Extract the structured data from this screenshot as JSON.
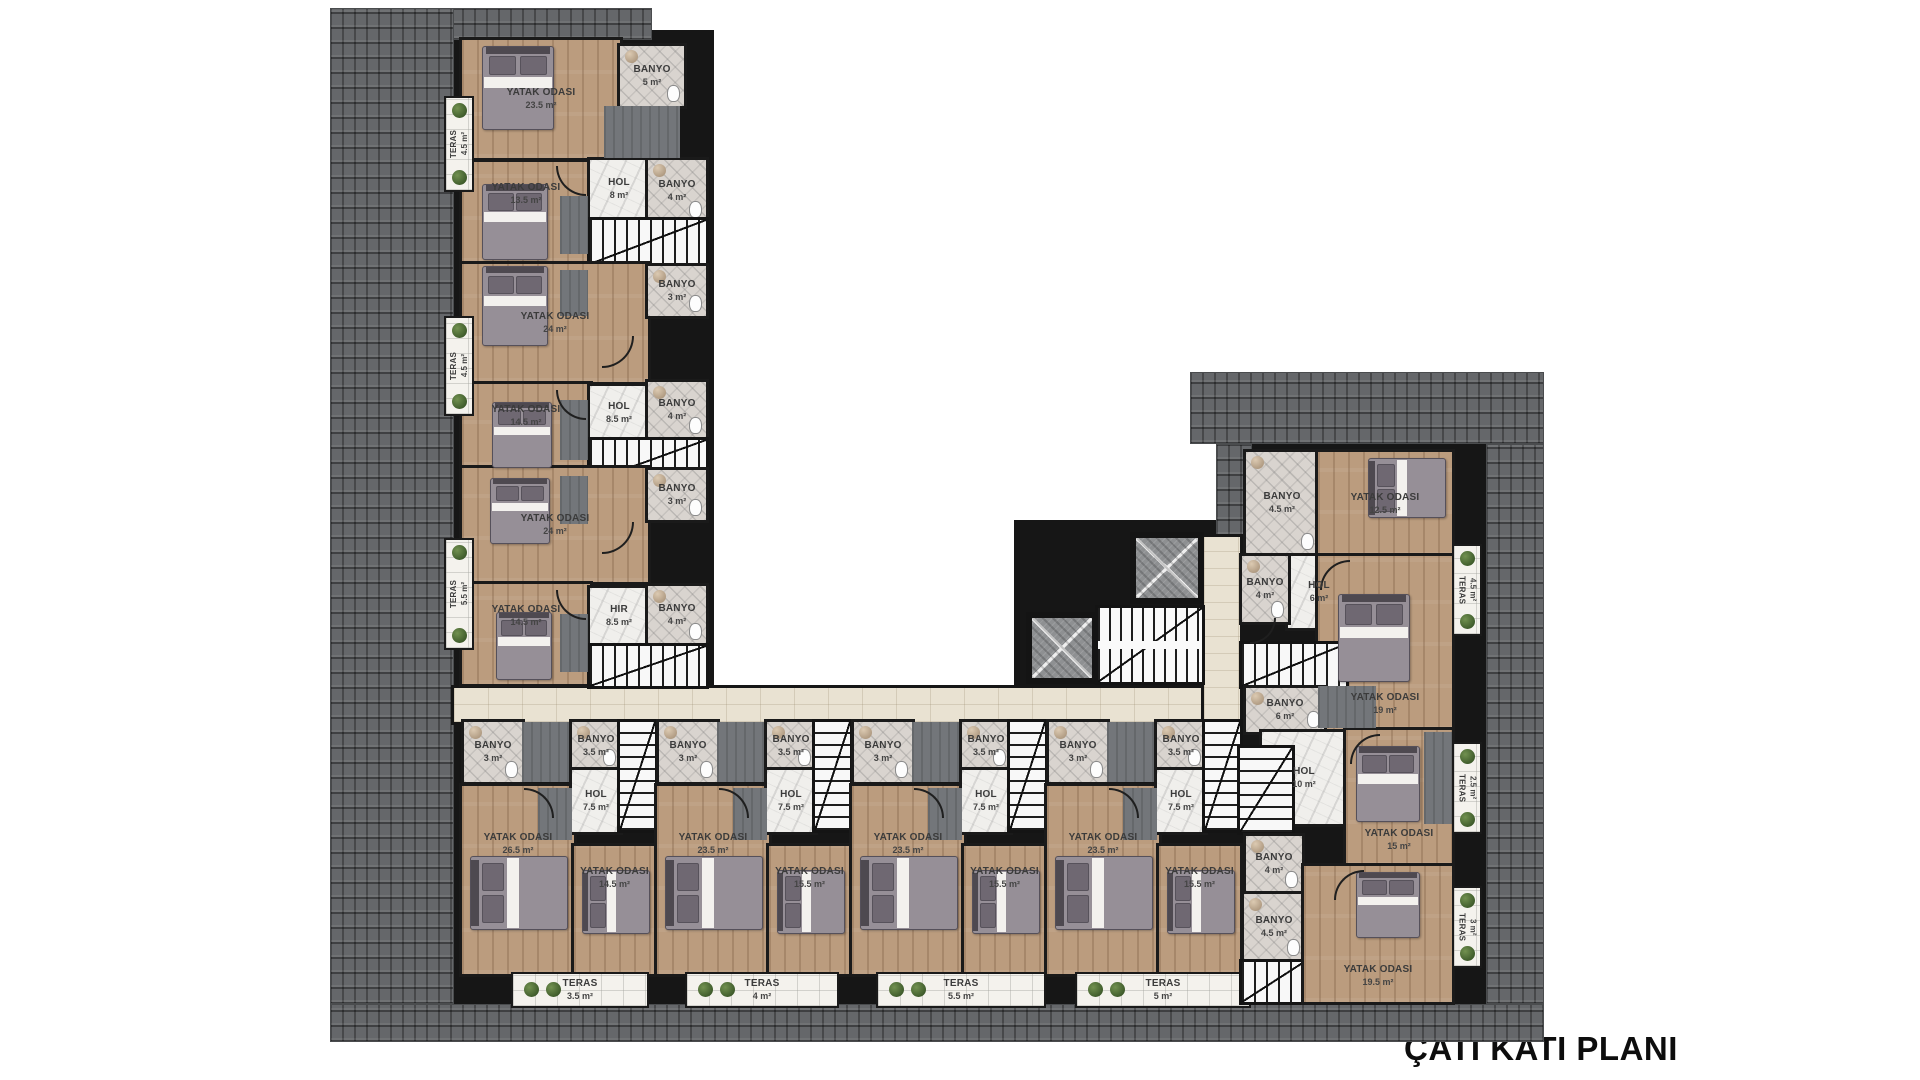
{
  "title": "ÇATI KATI PLANI",
  "title_pos": {
    "x": 1404,
    "y": 1030
  },
  "palette": {
    "roof": "#65676a",
    "wall": "#161616",
    "wood": "#bb9c7e",
    "marble": "#f0efec",
    "bath": "#d9d4cf",
    "travertine": "#e9e2d2",
    "terrace": "#f4f2ed",
    "plant": "#44612f"
  },
  "elements": [
    {
      "t": "wallbg",
      "x": 452,
      "y": 30,
      "w": 262,
      "h": 660
    },
    {
      "t": "wallbg",
      "x": 452,
      "y": 712,
      "w": 802,
      "h": 296
    },
    {
      "t": "wallbg",
      "x": 1236,
      "y": 444,
      "w": 250,
      "h": 562
    },
    {
      "t": "wallbg",
      "x": 1014,
      "y": 520,
      "w": 204,
      "h": 172
    },
    {
      "t": "roof",
      "x": 330,
      "y": 8,
      "w": 322,
      "h": 32
    },
    {
      "t": "roof",
      "x": 330,
      "y": 8,
      "w": 124,
      "h": 996
    },
    {
      "t": "roof",
      "x": 330,
      "y": 1004,
      "w": 1214,
      "h": 38
    },
    {
      "t": "roof",
      "x": 553,
      "y": 40,
      "w": 62,
      "h": 46
    },
    {
      "t": "roof",
      "x": 1190,
      "y": 372,
      "w": 354,
      "h": 72
    },
    {
      "t": "roof",
      "x": 1216,
      "y": 444,
      "w": 36,
      "h": 92
    },
    {
      "t": "roof",
      "x": 1486,
      "y": 444,
      "w": 58,
      "h": 560
    },
    {
      "t": "corridor",
      "x": 454,
      "y": 688,
      "w": 758,
      "h": 34
    },
    {
      "t": "corridor",
      "x": 1204,
      "y": 537,
      "w": 36,
      "h": 185
    },
    {
      "t": "wood",
      "x": 462,
      "y": 40,
      "w": 158,
      "h": 118,
      "l": "YATAK ODASI",
      "a": "23.5 m²"
    },
    {
      "t": "bath",
      "x": 620,
      "y": 46,
      "w": 64,
      "h": 60,
      "l": "BANYO",
      "a": "5 m²"
    },
    {
      "t": "wood",
      "x": 462,
      "y": 162,
      "w": 128,
      "h": 100,
      "l": "YATAK ODASI",
      "a": "13.5 m²",
      "lp": "t"
    },
    {
      "t": "marble",
      "x": 590,
      "y": 160,
      "w": 58,
      "h": 58,
      "l": "HOL",
      "a": "8 m²"
    },
    {
      "t": "bath",
      "x": 648,
      "y": 160,
      "w": 58,
      "h": 62,
      "l": "BANYO",
      "a": "4 m²"
    },
    {
      "t": "stairsv",
      "x": 590,
      "y": 220,
      "w": 116,
      "h": 44
    },
    {
      "t": "wood",
      "x": 462,
      "y": 264,
      "w": 186,
      "h": 118,
      "l": "YATAK ODASI",
      "a": "24 m²"
    },
    {
      "t": "bath",
      "x": 648,
      "y": 266,
      "w": 58,
      "h": 50,
      "l": "BANYO",
      "a": "3 m²"
    },
    {
      "t": "wood",
      "x": 462,
      "y": 384,
      "w": 128,
      "h": 82,
      "l": "YATAK ODASI",
      "a": "14.5 m²",
      "lp": "t"
    },
    {
      "t": "marble",
      "x": 590,
      "y": 386,
      "w": 58,
      "h": 54,
      "l": "HOL",
      "a": "8.5 m²"
    },
    {
      "t": "bath",
      "x": 648,
      "y": 382,
      "w": 58,
      "h": 56,
      "l": "BANYO",
      "a": "4 m²"
    },
    {
      "t": "stairsv",
      "x": 590,
      "y": 440,
      "w": 116,
      "h": 42
    },
    {
      "t": "wood",
      "x": 462,
      "y": 468,
      "w": 186,
      "h": 114,
      "l": "YATAK ODASI",
      "a": "24 m²"
    },
    {
      "t": "bath",
      "x": 648,
      "y": 470,
      "w": 58,
      "h": 50,
      "l": "BANYO",
      "a": "3 m²"
    },
    {
      "t": "wood",
      "x": 462,
      "y": 584,
      "w": 128,
      "h": 100,
      "l": "YATAK ODASI",
      "a": "14.5 m²",
      "lp": "t"
    },
    {
      "t": "marble",
      "x": 590,
      "y": 588,
      "w": 58,
      "h": 56,
      "l": "HIR",
      "a": "8.5 m²"
    },
    {
      "t": "bath",
      "x": 648,
      "y": 586,
      "w": 58,
      "h": 58,
      "l": "BANYO",
      "a": "4 m²"
    },
    {
      "t": "stairsv",
      "x": 590,
      "y": 646,
      "w": 116,
      "h": 40
    },
    {
      "t": "patch",
      "x": 604,
      "y": 106,
      "w": 76,
      "h": 52
    },
    {
      "t": "patch",
      "x": 560,
      "y": 196,
      "w": 28,
      "h": 58
    },
    {
      "t": "patch",
      "x": 560,
      "y": 270,
      "w": 28,
      "h": 46
    },
    {
      "t": "patch",
      "x": 560,
      "y": 400,
      "w": 28,
      "h": 60
    },
    {
      "t": "patch",
      "x": 560,
      "y": 476,
      "w": 28,
      "h": 48
    },
    {
      "t": "patch",
      "x": 560,
      "y": 614,
      "w": 28,
      "h": 58
    },
    {
      "t": "terasvl",
      "x": 446,
      "y": 98,
      "w": 26,
      "h": 92,
      "l": "TERAS",
      "a": "4.5 m²"
    },
    {
      "t": "terasvl",
      "x": 446,
      "y": 318,
      "w": 26,
      "h": 96,
      "l": "TERAS",
      "a": "4.5 m²"
    },
    {
      "t": "terasvl",
      "x": 446,
      "y": 540,
      "w": 26,
      "h": 108,
      "l": "TERAS",
      "a": "5.5 m²"
    },
    {
      "t": "wood",
      "x": 462,
      "y": 786,
      "w": 112,
      "h": 188,
      "l": "YATAK ODASI",
      "a": "26.5 m²",
      "lp": "t2"
    },
    {
      "t": "wood",
      "x": 574,
      "y": 846,
      "w": 81,
      "h": 128,
      "l": "YATAK ODASI",
      "a": "14.5 m²",
      "lp": "t"
    },
    {
      "t": "bath",
      "x": 464,
      "y": 722,
      "w": 58,
      "h": 60,
      "l": "BANYO",
      "a": "3 m²"
    },
    {
      "t": "patch",
      "x": 522,
      "y": 722,
      "w": 50,
      "h": 60
    },
    {
      "t": "bath",
      "x": 572,
      "y": 722,
      "w": 48,
      "h": 48,
      "l": "BANYO",
      "a": "3.5 m²"
    },
    {
      "t": "marble",
      "x": 572,
      "y": 770,
      "w": 48,
      "h": 62,
      "l": "HOL",
      "a": "7.5 m²"
    },
    {
      "t": "stairsh",
      "x": 620,
      "y": 722,
      "w": 35,
      "h": 108
    },
    {
      "t": "patch",
      "x": 538,
      "y": 788,
      "w": 34,
      "h": 52
    },
    {
      "t": "wood",
      "x": 657,
      "y": 786,
      "w": 112,
      "h": 188,
      "l": "YATAK ODASI",
      "a": "23.5 m²",
      "lp": "t2"
    },
    {
      "t": "wood",
      "x": 769,
      "y": 846,
      "w": 81,
      "h": 128,
      "l": "YATAK ODASI",
      "a": "15.5 m²",
      "lp": "t"
    },
    {
      "t": "bath",
      "x": 659,
      "y": 722,
      "w": 58,
      "h": 60,
      "l": "BANYO",
      "a": "3 m²"
    },
    {
      "t": "patch",
      "x": 717,
      "y": 722,
      "w": 50,
      "h": 60
    },
    {
      "t": "bath",
      "x": 767,
      "y": 722,
      "w": 48,
      "h": 48,
      "l": "BANYO",
      "a": "3.5 m²"
    },
    {
      "t": "marble",
      "x": 767,
      "y": 770,
      "w": 48,
      "h": 62,
      "l": "HOL",
      "a": "7.5 m²"
    },
    {
      "t": "stairsh",
      "x": 815,
      "y": 722,
      "w": 35,
      "h": 108
    },
    {
      "t": "patch",
      "x": 733,
      "y": 788,
      "w": 34,
      "h": 52
    },
    {
      "t": "wood",
      "x": 852,
      "y": 786,
      "w": 112,
      "h": 188,
      "l": "YATAK ODASI",
      "a": "23.5 m²",
      "lp": "t2"
    },
    {
      "t": "wood",
      "x": 964,
      "y": 846,
      "w": 81,
      "h": 128,
      "l": "YATAK ODASI",
      "a": "15.5 m²",
      "lp": "t"
    },
    {
      "t": "bath",
      "x": 854,
      "y": 722,
      "w": 58,
      "h": 60,
      "l": "BANYO",
      "a": "3 m²"
    },
    {
      "t": "patch",
      "x": 912,
      "y": 722,
      "w": 50,
      "h": 60
    },
    {
      "t": "bath",
      "x": 962,
      "y": 722,
      "w": 48,
      "h": 48,
      "l": "BANYO",
      "a": "3.5 m²"
    },
    {
      "t": "marble",
      "x": 962,
      "y": 770,
      "w": 48,
      "h": 62,
      "l": "HOL",
      "a": "7.5 m²"
    },
    {
      "t": "stairsh",
      "x": 1010,
      "y": 722,
      "w": 35,
      "h": 108
    },
    {
      "t": "patch",
      "x": 928,
      "y": 788,
      "w": 34,
      "h": 52
    },
    {
      "t": "wood",
      "x": 1047,
      "y": 786,
      "w": 112,
      "h": 188,
      "l": "YATAK ODASI",
      "a": "23.5 m²",
      "lp": "t2"
    },
    {
      "t": "wood",
      "x": 1159,
      "y": 846,
      "w": 81,
      "h": 128,
      "l": "YATAK ODASI",
      "a": "15.5 m²",
      "lp": "t"
    },
    {
      "t": "bath",
      "x": 1049,
      "y": 722,
      "w": 58,
      "h": 60,
      "l": "BANYO",
      "a": "3 m²"
    },
    {
      "t": "patch",
      "x": 1107,
      "y": 722,
      "w": 50,
      "h": 60
    },
    {
      "t": "bath",
      "x": 1157,
      "y": 722,
      "w": 48,
      "h": 48,
      "l": "BANYO",
      "a": "3.5 m²"
    },
    {
      "t": "marble",
      "x": 1157,
      "y": 770,
      "w": 48,
      "h": 62,
      "l": "HOL",
      "a": "7.5 m²"
    },
    {
      "t": "stairsh",
      "x": 1205,
      "y": 722,
      "w": 35,
      "h": 108
    },
    {
      "t": "patch",
      "x": 1123,
      "y": 788,
      "w": 34,
      "h": 52
    },
    {
      "t": "teras",
      "x": 513,
      "y": 974,
      "w": 134,
      "h": 32,
      "l": "TERAS",
      "a": "3.5 m²"
    },
    {
      "t": "teras",
      "x": 687,
      "y": 974,
      "w": 150,
      "h": 32,
      "l": "TERAS",
      "a": "4 m²"
    },
    {
      "t": "teras",
      "x": 878,
      "y": 974,
      "w": 166,
      "h": 32,
      "l": "TERAS",
      "a": "5.5 m²"
    },
    {
      "t": "teras",
      "x": 1077,
      "y": 974,
      "w": 172,
      "h": 32,
      "l": "TERAS",
      "a": "5 m²"
    },
    {
      "t": "elevator",
      "x": 1130,
      "y": 532,
      "w": 74,
      "h": 72
    },
    {
      "t": "elevator",
      "x": 1026,
      "y": 612,
      "w": 72,
      "h": 72
    },
    {
      "t": "stairmain",
      "x": 1098,
      "y": 608,
      "w": 104,
      "h": 74
    },
    {
      "t": "bath",
      "x": 1246,
      "y": 452,
      "w": 72,
      "h": 102,
      "l": "BANYO",
      "a": "4.5 m²"
    },
    {
      "t": "wood",
      "x": 1318,
      "y": 452,
      "w": 134,
      "h": 104,
      "l": "YATAK ODASI",
      "a": "12.5 m²"
    },
    {
      "t": "marble",
      "x": 1288,
      "y": 556,
      "w": 62,
      "h": 72,
      "l": "HOL",
      "a": "6 m²"
    },
    {
      "t": "bath",
      "x": 1242,
      "y": 556,
      "w": 46,
      "h": 66,
      "l": "BANYO",
      "a": "4 m²"
    },
    {
      "t": "wood",
      "x": 1318,
      "y": 556,
      "w": 134,
      "h": 174,
      "l": "YATAK ODASI",
      "a": "19 m²",
      "lp": "b"
    },
    {
      "t": "stairsv",
      "x": 1242,
      "y": 644,
      "w": 104,
      "h": 42
    },
    {
      "t": "bath",
      "x": 1246,
      "y": 688,
      "w": 78,
      "h": 44,
      "l": "BANYO",
      "a": "6 m²"
    },
    {
      "t": "marble",
      "x": 1262,
      "y": 732,
      "w": 84,
      "h": 92,
      "l": "HOL",
      "a": "10 m²"
    },
    {
      "t": "stairsh",
      "x": 1240,
      "y": 748,
      "w": 52,
      "h": 84
    },
    {
      "t": "bath",
      "x": 1246,
      "y": 836,
      "w": 56,
      "h": 56,
      "l": "BANYO",
      "a": "4 m²"
    },
    {
      "t": "wood",
      "x": 1346,
      "y": 730,
      "w": 106,
      "h": 136,
      "l": "YATAK ODASI",
      "a": "15 m²",
      "lp": "b"
    },
    {
      "t": "bath",
      "x": 1244,
      "y": 894,
      "w": 60,
      "h": 66,
      "l": "BANYO",
      "a": "4.5 m²"
    },
    {
      "t": "stairsv",
      "x": 1242,
      "y": 962,
      "w": 62,
      "h": 40
    },
    {
      "t": "wood",
      "x": 1304,
      "y": 866,
      "w": 148,
      "h": 136,
      "l": "YATAK ODASI",
      "a": "19.5 m²",
      "lp": "b"
    },
    {
      "t": "patch",
      "x": 1318,
      "y": 686,
      "w": 58,
      "h": 42
    },
    {
      "t": "patch",
      "x": 1424,
      "y": 732,
      "w": 28,
      "h": 92
    },
    {
      "t": "terasvr",
      "x": 1454,
      "y": 546,
      "w": 26,
      "h": 88,
      "l": "TERAS",
      "a": "4.5 m²"
    },
    {
      "t": "terasvr",
      "x": 1454,
      "y": 744,
      "w": 26,
      "h": 88,
      "l": "TERAS",
      "a": "2.5 m²"
    },
    {
      "t": "terasvr",
      "x": 1454,
      "y": 888,
      "w": 26,
      "h": 78,
      "l": "TERAS",
      "a": "3 m²"
    },
    {
      "t": "bed",
      "x": 482,
      "y": 46,
      "w": 72,
      "h": 84,
      "dir": "n"
    },
    {
      "t": "bed",
      "x": 482,
      "y": 184,
      "w": 66,
      "h": 76,
      "dir": "n"
    },
    {
      "t": "bed",
      "x": 482,
      "y": 266,
      "w": 66,
      "h": 80,
      "dir": "n"
    },
    {
      "t": "bed",
      "x": 492,
      "y": 402,
      "w": 60,
      "h": 66,
      "dir": "n"
    },
    {
      "t": "bed",
      "x": 490,
      "y": 478,
      "w": 60,
      "h": 66,
      "dir": "n"
    },
    {
      "t": "bed",
      "x": 496,
      "y": 612,
      "w": 56,
      "h": 68,
      "dir": "n"
    },
    {
      "t": "bed",
      "x": 470,
      "y": 856,
      "w": 98,
      "h": 74,
      "dir": "w"
    },
    {
      "t": "bed",
      "x": 582,
      "y": 870,
      "w": 68,
      "h": 64,
      "dir": "w"
    },
    {
      "t": "bed",
      "x": 665,
      "y": 856,
      "w": 98,
      "h": 74,
      "dir": "w"
    },
    {
      "t": "bed",
      "x": 777,
      "y": 870,
      "w": 68,
      "h": 64,
      "dir": "w"
    },
    {
      "t": "bed",
      "x": 860,
      "y": 856,
      "w": 98,
      "h": 74,
      "dir": "w"
    },
    {
      "t": "bed",
      "x": 972,
      "y": 870,
      "w": 68,
      "h": 64,
      "dir": "w"
    },
    {
      "t": "bed",
      "x": 1055,
      "y": 856,
      "w": 98,
      "h": 74,
      "dir": "w"
    },
    {
      "t": "bed",
      "x": 1167,
      "y": 870,
      "w": 68,
      "h": 64,
      "dir": "w"
    },
    {
      "t": "bed",
      "x": 1368,
      "y": 458,
      "w": 78,
      "h": 60,
      "dir": "w"
    },
    {
      "t": "bed",
      "x": 1338,
      "y": 594,
      "w": 72,
      "h": 88,
      "dir": "n"
    },
    {
      "t": "bed",
      "x": 1356,
      "y": 746,
      "w": 64,
      "h": 76,
      "dir": "n"
    },
    {
      "t": "bed",
      "x": 1356,
      "y": 872,
      "w": 64,
      "h": 66,
      "dir": "n"
    },
    {
      "t": "door",
      "x": 556,
      "y": 166,
      "s": 30,
      "r": "se"
    },
    {
      "t": "door",
      "x": 602,
      "y": 336,
      "s": 32,
      "r": "ne"
    },
    {
      "t": "door",
      "x": 556,
      "y": 390,
      "s": 30,
      "r": "se"
    },
    {
      "t": "door",
      "x": 602,
      "y": 522,
      "s": 32,
      "r": "ne"
    },
    {
      "t": "door",
      "x": 556,
      "y": 590,
      "s": 30,
      "r": "se"
    },
    {
      "t": "door",
      "x": 524,
      "y": 788,
      "s": 30,
      "r": "nw"
    },
    {
      "t": "door",
      "x": 719,
      "y": 788,
      "s": 30,
      "r": "nw"
    },
    {
      "t": "door",
      "x": 914,
      "y": 788,
      "s": 30,
      "r": "nw"
    },
    {
      "t": "door",
      "x": 1109,
      "y": 788,
      "s": 30,
      "r": "nw"
    },
    {
      "t": "door",
      "x": 1320,
      "y": 560,
      "s": 30,
      "r": "sw"
    },
    {
      "t": "door",
      "x": 1350,
      "y": 734,
      "s": 30,
      "r": "sw"
    },
    {
      "t": "door",
      "x": 1334,
      "y": 870,
      "s": 30,
      "r": "sw"
    },
    {
      "t": "door",
      "x": 1250,
      "y": 618,
      "s": 26,
      "r": "ne"
    }
  ]
}
